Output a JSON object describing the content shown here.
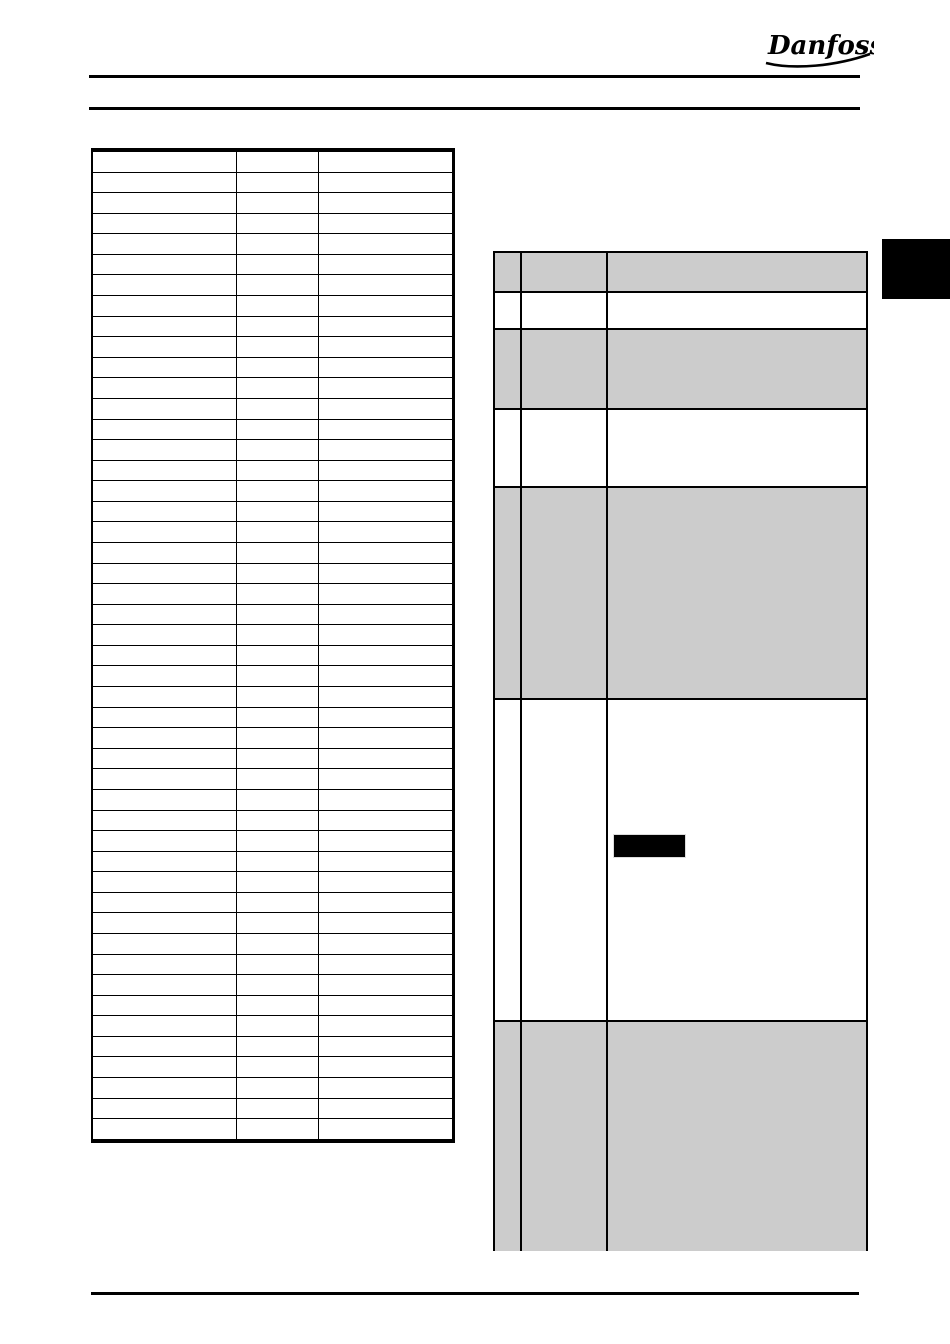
{
  "page": {
    "width": 950,
    "height": 1344,
    "background": "#ffffff"
  },
  "header": {
    "logo_text": "Danfoss",
    "rule_color": "#000000"
  },
  "left_table": {
    "columns": [
      "",
      "",
      ""
    ],
    "row_count": 48,
    "cell_text": ""
  },
  "right_table": {
    "columns": [
      "",
      "",
      ""
    ],
    "shade_color": "#cccccc",
    "rows": [
      {
        "shade": true,
        "height": 40,
        "cells": [
          "",
          "",
          ""
        ]
      },
      {
        "shade": false,
        "height": 37,
        "cells": [
          "",
          "",
          ""
        ]
      },
      {
        "shade": true,
        "height": 80,
        "cells": [
          "",
          "",
          ""
        ]
      },
      {
        "shade": false,
        "height": 78,
        "cells": [
          "",
          "",
          ""
        ]
      },
      {
        "shade": true,
        "height": 212,
        "cells": [
          "",
          "",
          ""
        ]
      },
      {
        "shade": false,
        "height": 322,
        "cells": [
          "",
          "",
          ""
        ],
        "has_black_box": true
      },
      {
        "shade": true,
        "height": 229,
        "cells": [
          "",
          "",
          ""
        ]
      }
    ]
  },
  "side_tab": {
    "color": "#000000"
  },
  "black_box": {
    "color": "#000000"
  },
  "footer": {
    "rule_color": "#000000"
  }
}
